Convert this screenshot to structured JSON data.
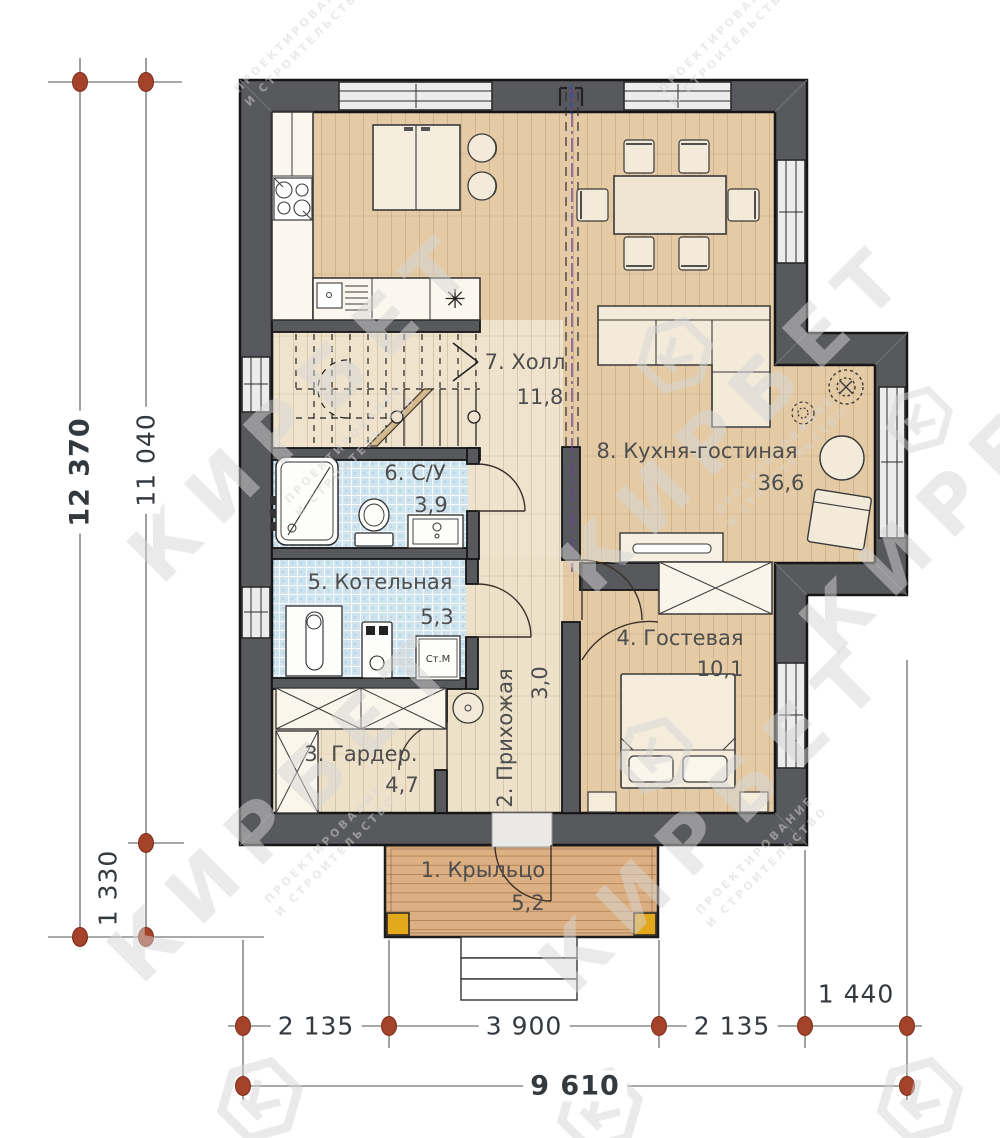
{
  "watermark": {
    "brand": "КИРБЕТ",
    "tagline1": "ПРОЕКТИРОВАНИЕ",
    "tagline2": "И СТРОИТЕЛЬСТВО"
  },
  "rooms": [
    {
      "label": "1. Крыльцо",
      "area": "5,2"
    },
    {
      "label": "2. Прихожая",
      "area": "3,0"
    },
    {
      "label": "3. Гардер.",
      "area": "4,7"
    },
    {
      "label": "4. Гостевая",
      "area": "10,1"
    },
    {
      "label": "5. Котельная",
      "area": "5,3"
    },
    {
      "label": "6. С/У",
      "area": "3,9"
    },
    {
      "label": "7. Холл",
      "area": "11,8"
    },
    {
      "label": "8. Кухня-гостиная",
      "area": "36,6"
    }
  ],
  "dimensions": {
    "overall_height": "12 370",
    "inner_height": "11 040",
    "porch_height": "1 330",
    "bottom_left": "2 135",
    "bottom_center": "3 900",
    "bottom_right": "2 135",
    "right_offset": "1 440",
    "overall_width": "9 610"
  },
  "appliances": {
    "washing_machine": "Ст.М"
  },
  "symbols": {
    "sink": "✳"
  },
  "colors": {
    "wall": "#58595c",
    "wood_floor": "#e4cba6",
    "hall_floor": "#efe3cd",
    "tile_floor": "#cfe3ee",
    "porch_floor": "#ddb083",
    "axis_dot": "#a5422a",
    "zone_line": "#6a3fa0"
  }
}
